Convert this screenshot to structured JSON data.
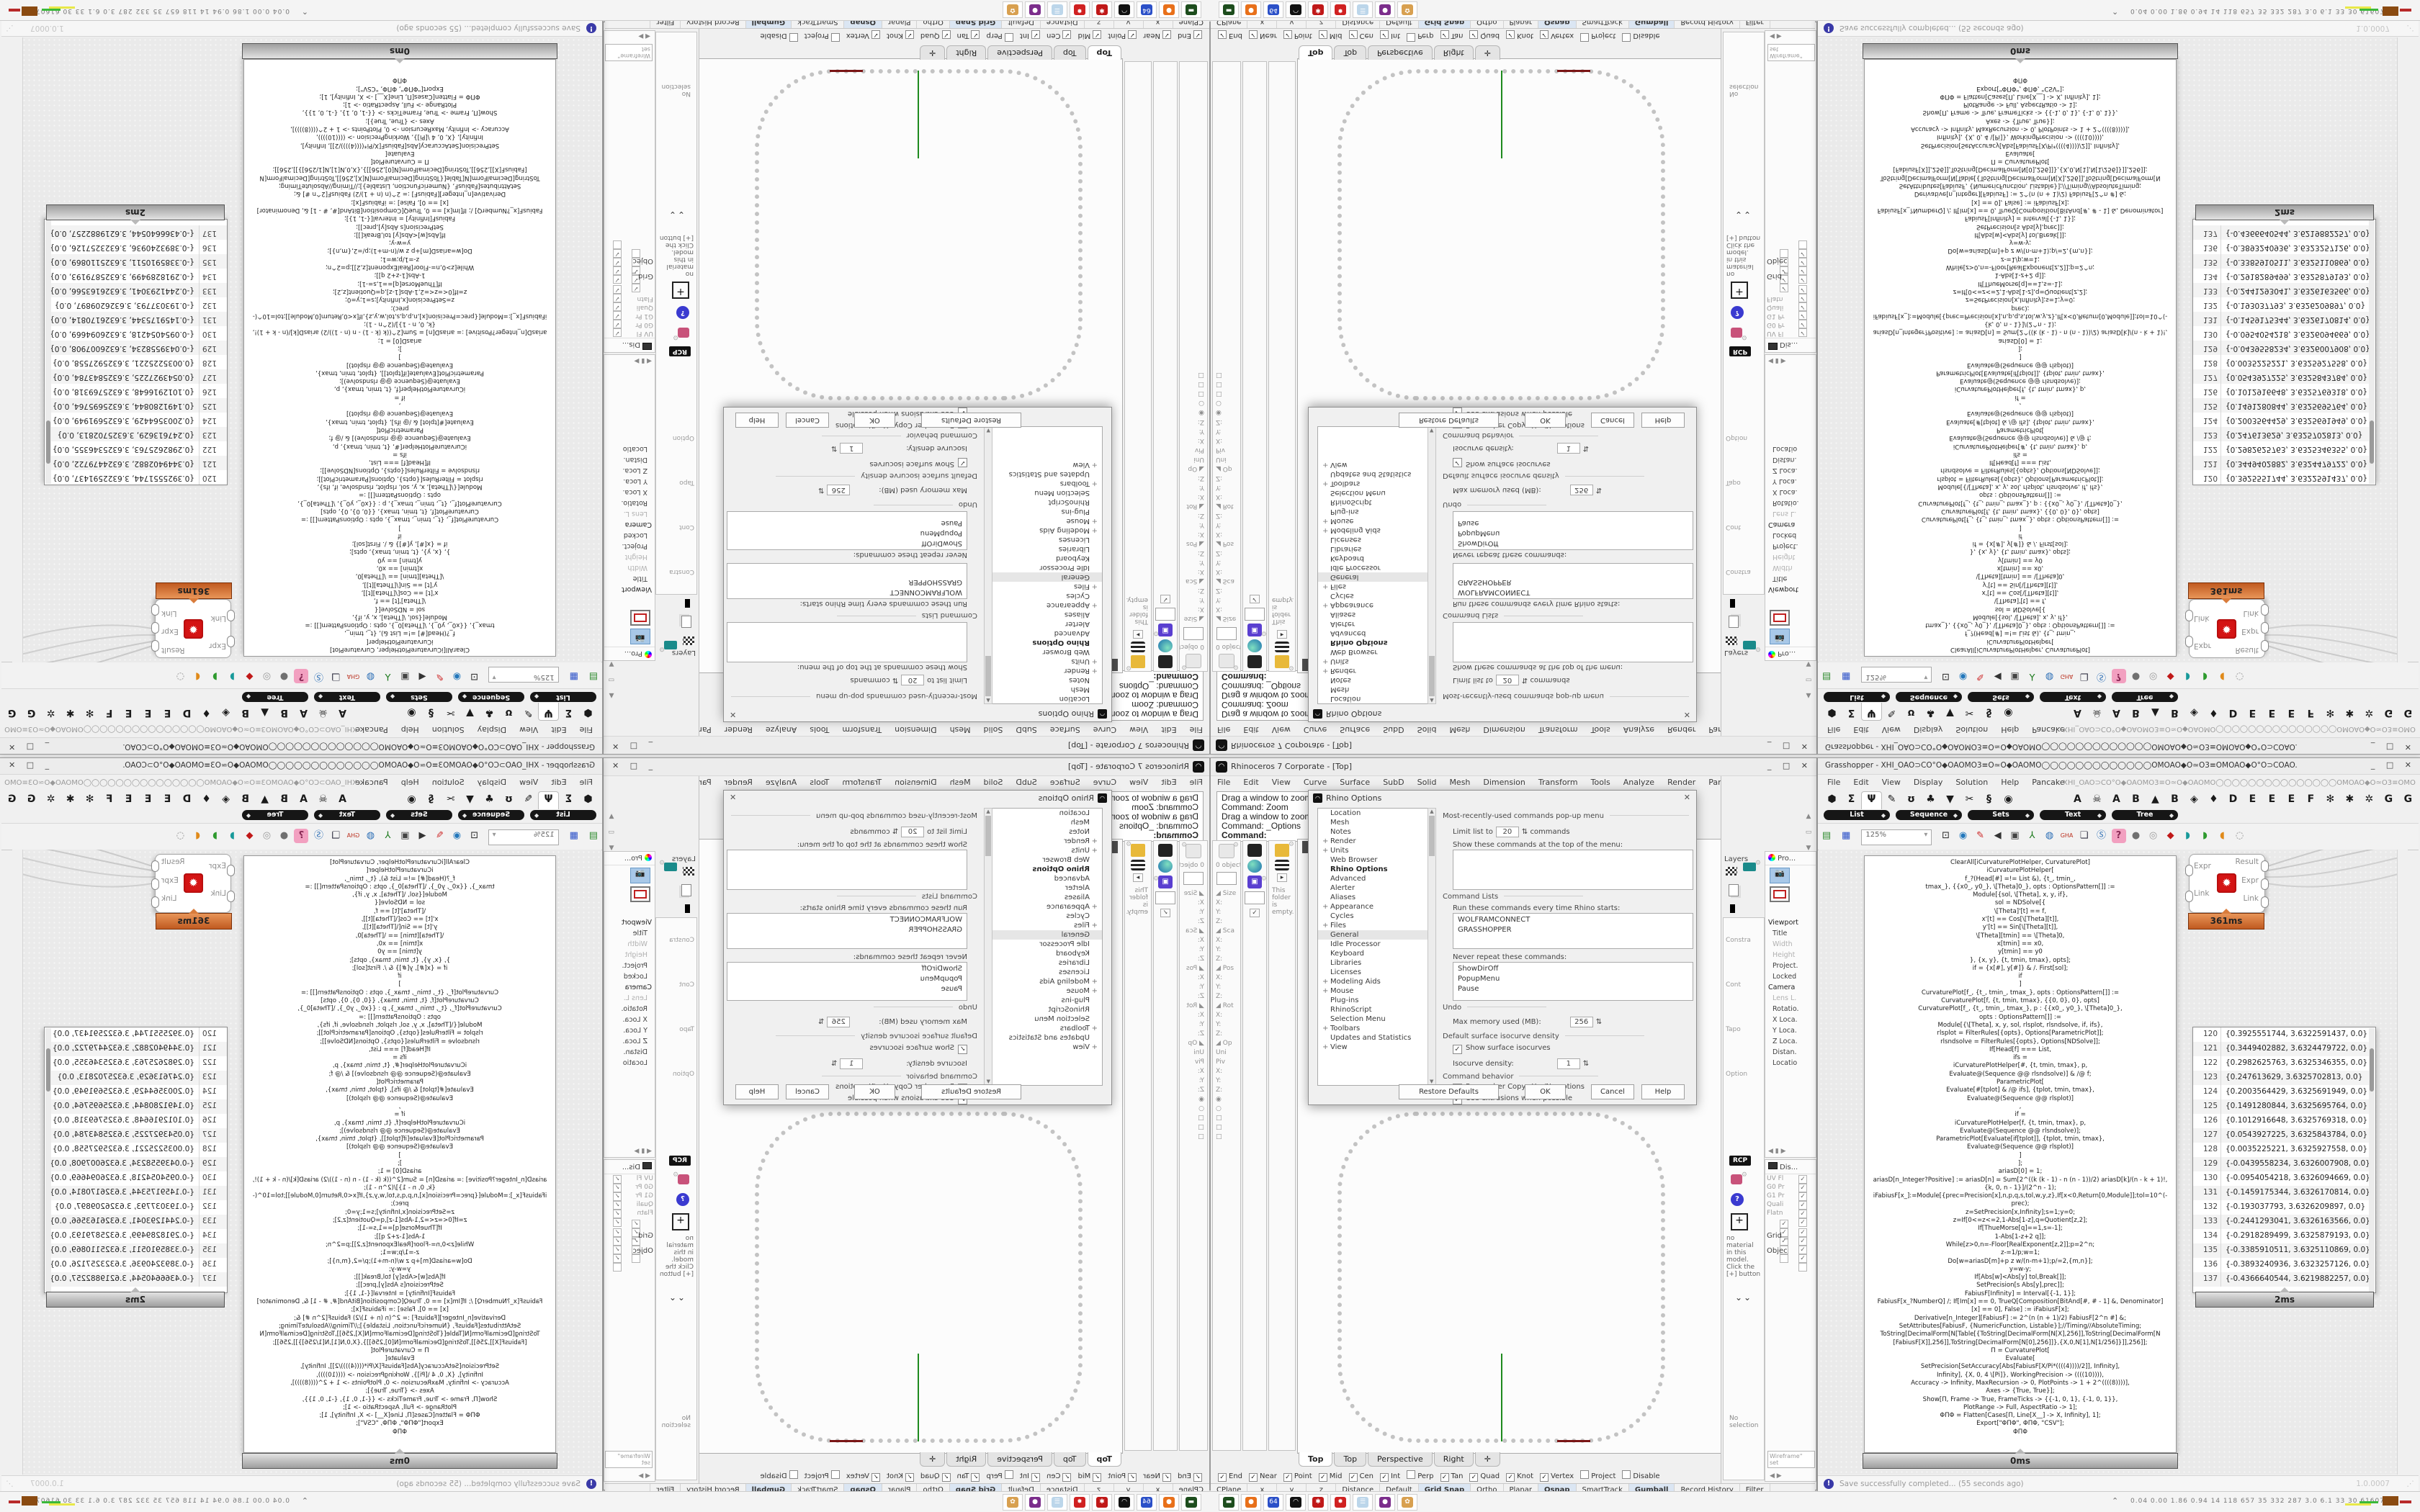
{
  "rhino": {
    "title": "Rhinoceros 7 Corporate - [Top]",
    "window_buttons": "_ □ ✕",
    "menus": [
      "File",
      "Edit",
      "View",
      "Curve",
      "Surface",
      "SubD",
      "Solid",
      "Mesh",
      "Dimension",
      "Transform",
      "Tools",
      "Analyze",
      "Render",
      "Panels",
      "Help"
    ],
    "command_lines": [
      "Drag a window to zoom (",
      "Command: Zoom",
      "Drag a window to zoom (",
      "Command: _Options",
      "Command:"
    ],
    "left_strips": {
      "objects_count": "0 objects",
      "rows": [
        "◢ Size",
        "X:",
        "Y:",
        "Z:",
        "◢ Sca",
        "X:",
        "Y:",
        "Z:",
        "◢ Pos",
        "X:",
        "Y:",
        "Z:",
        "◢ Rot",
        "X:",
        "Y:",
        "Z:",
        "◢ Op",
        "Uni",
        "Piv",
        "X:",
        "Y:",
        "Z:",
        "◉",
        "○",
        "□",
        "□",
        "□"
      ],
      "check": "✓",
      "folder_empty": "This folder is empty.",
      "expand_arrow": "▸"
    },
    "viewport": {
      "label": "Top",
      "tabs": [
        {
          "label": "Top",
          "cls": "active"
        },
        {
          "label": "Top"
        },
        {
          "label": "Perspective"
        },
        {
          "label": "Right"
        },
        {
          "label": "✛"
        }
      ]
    },
    "osnap": [
      {
        "label": "End",
        "chk": "✓"
      },
      {
        "label": "Near",
        "chk": "✓"
      },
      {
        "label": "Point",
        "chk": "✓"
      },
      {
        "label": "Mid",
        "chk": "✓"
      },
      {
        "label": "Cen",
        "chk": "✓"
      },
      {
        "label": "Int",
        "chk": "✓"
      },
      {
        "label": "Perp",
        "chk": ""
      },
      {
        "label": "Tan",
        "chk": "✓"
      },
      {
        "label": "Quad",
        "chk": "✓"
      },
      {
        "label": "Knot",
        "chk": "✓"
      },
      {
        "label": "Vertex",
        "chk": "✓"
      },
      {
        "label": "Project",
        "chk": ""
      },
      {
        "label": "Disable",
        "chk": ""
      }
    ],
    "status_cells": [
      {
        "label": "CPlane",
        "cls": ""
      },
      {
        "label": "x",
        "cls": "wide"
      },
      {
        "label": "y",
        "cls": "wide"
      },
      {
        "label": "z",
        "cls": "wide"
      },
      {
        "label": "Distance",
        "cls": ""
      },
      {
        "label": "Default",
        "cls": "swatch"
      },
      {
        "label": "Grid Snap",
        "cls": "hl"
      },
      {
        "label": "Ortho",
        "cls": ""
      },
      {
        "label": "Planar",
        "cls": ""
      },
      {
        "label": "Osnap",
        "cls": "hl"
      },
      {
        "label": "SmartTrack",
        "cls": ""
      },
      {
        "label": "Gumball",
        "cls": "hl"
      },
      {
        "label": "Record History",
        "cls": ""
      },
      {
        "label": "Filter",
        "cls": ""
      }
    ],
    "options_dialog": {
      "title": "Rhino Options",
      "tree": [
        {
          "label": "Location",
          "plus": ""
        },
        {
          "label": "Mesh",
          "plus": ""
        },
        {
          "label": "Notes",
          "plus": ""
        },
        {
          "label": "Render",
          "plus": "+"
        },
        {
          "label": "Units",
          "plus": "+"
        },
        {
          "label": "Web Browser",
          "plus": ""
        },
        {
          "label": "Rhino Options",
          "plus": "",
          "cls": "hdr"
        },
        {
          "label": "Advanced",
          "plus": ""
        },
        {
          "label": "Alerter",
          "plus": ""
        },
        {
          "label": "Aliases",
          "plus": ""
        },
        {
          "label": "Appearance",
          "plus": "+"
        },
        {
          "label": "Cycles",
          "plus": ""
        },
        {
          "label": "Files",
          "plus": "+"
        },
        {
          "label": "General",
          "plus": "",
          "cls": "sel"
        },
        {
          "label": "Idle Processor",
          "plus": ""
        },
        {
          "label": "Keyboard",
          "plus": ""
        },
        {
          "label": "Libraries",
          "plus": ""
        },
        {
          "label": "Licenses",
          "plus": ""
        },
        {
          "label": "Modeling Aids",
          "plus": "+"
        },
        {
          "label": "Mouse",
          "plus": "+"
        },
        {
          "label": "Plug-ins",
          "plus": ""
        },
        {
          "label": "RhinoScript",
          "plus": ""
        },
        {
          "label": "Selection Menu",
          "plus": ""
        },
        {
          "label": "Toolbars",
          "plus": "+"
        },
        {
          "label": "Updates and Statistics",
          "plus": ""
        },
        {
          "label": "View",
          "plus": "+"
        }
      ],
      "mru_header": "Most-recently-used commands pop-up menu",
      "limit_label": "Limit list to",
      "limit_value": "20",
      "limit_suffix": "commands",
      "show_cmds_label": "Show these commands at the top of the menu:",
      "cmd_lists_header": "Command Lists",
      "run_label": "Run these commands every time Rhino starts:",
      "run_items": [
        "WOLFRAMCONNECT",
        "GRASSHOPPER"
      ],
      "never_label": "Never repeat these commands:",
      "never_items": [
        "ShowDirOff",
        "PopupMenu",
        "Pause"
      ],
      "undo_header": "Undo",
      "max_mem_label": "Max memory used (MB):",
      "max_mem_value": "256",
      "iso_header": "Default surface isocurve density",
      "show_iso_label": "Show surface isocurves",
      "iso_density_label": "Isocurve density:",
      "iso_density_value": "1",
      "behavior_header": "Command behavior",
      "remember_label": "Remember Copy=Yes/No options",
      "extrusions_label": "Use extrusions when possible",
      "buttons": [
        "Restore Defaults",
        "OK",
        "Cancel",
        "Help"
      ]
    },
    "right_dock": {
      "layers_label": "Layers",
      "strip_labels": [
        "Constra",
        "Cont",
        "Tapo",
        "Option"
      ],
      "rcp_label": "RCP",
      "materials_empty": "no material in this model. Click the [+] button",
      "chevrons": "⌄⌄",
      "no_selection": "No selection",
      "properties": {
        "header": "Pro...",
        "rows": [
          {
            "label": "Viewport",
            "cls": "sec"
          },
          {
            "label": "Title",
            "cls": ""
          },
          {
            "label": "Width",
            "cls": "dim"
          },
          {
            "label": "Height",
            "cls": "dim"
          },
          {
            "label": "Project.",
            "cls": ""
          },
          {
            "label": "Locked",
            "cls": ""
          },
          {
            "label": "Camera",
            "cls": "sec"
          },
          {
            "label": "Lens L.",
            "cls": "dim"
          },
          {
            "label": "Rotatio.",
            "cls": ""
          },
          {
            "label": "X Loca.",
            "cls": ""
          },
          {
            "label": "Y Loca.",
            "cls": ""
          },
          {
            "label": "Z Loca.",
            "cls": ""
          },
          {
            "label": "Distan.",
            "cls": ""
          },
          {
            "label": "Locatio",
            "cls": ""
          }
        ]
      },
      "display": {
        "header": "Dis...",
        "rows": [
          {
            "label": "UV Fl",
            "chk": "✓"
          },
          {
            "label": "G0 Pr",
            "chk": "✓"
          },
          {
            "label": "G1 Pr",
            "chk": "✓"
          },
          {
            "label": "Quali",
            "chk": "✓"
          },
          {
            "label": "Flatn",
            "chk": "✓"
          },
          {
            "label": "",
            "chk": "✓"
          },
          {
            "label": "",
            "chk": "✓"
          },
          {
            "label": "",
            "chk": "✓"
          },
          {
            "label": "",
            "chk": "✓"
          },
          {
            "label": "",
            "chk": "✓"
          },
          {
            "label": "",
            "chk": "✓"
          },
          {
            "label": "",
            "chk": "✓"
          }
        ],
        "grid_label": "Grid _",
        "grid_rows": [
          {
            "label": "",
            "chk": ""
          },
          {
            "label": "",
            "chk": "✓"
          },
          {
            "label": "",
            "chk": ""
          },
          {
            "label": "",
            "chk": ""
          }
        ],
        "object_label": "Objec",
        "wireframe_value": "Wireframe\" set"
      }
    }
  },
  "grasshopper": {
    "title": "Grasshopper - XHI_OAO⊃CO°O◆OAOMO3≡O≃O◆OAOMO◯◯◯◯◯◯◯◯◯◯◯◯◯OMOAO◆O≃O3≡OMOAO◆O°O⊃COAO.",
    "window_buttons": "_ □ ✕",
    "menus": [
      "File",
      "Edit",
      "View",
      "Display",
      "Solution",
      "Help",
      "Pancake"
    ],
    "doc_glyphs": "XHI_OAO⊃CO°O◆OAOMO3≡O≃O◆OAOMO◯◯◯◯◯◯◯◯◯◯◯◯◯◯◯OMOAO◆O≃O3≡OMOAO◆O°O⊃COAO.",
    "tab_icons": [
      {
        "g": "⬢",
        "name": "params-tab-icon",
        "cls": ""
      },
      {
        "g": "Σ",
        "name": "maths-tab-icon",
        "cls": ""
      },
      {
        "g": "Ψ",
        "name": "sets-tab-icon",
        "cls": "active"
      },
      {
        "g": "✎",
        "name": "vector-tab-icon",
        "cls": ""
      },
      {
        "g": "ʊ",
        "name": "curve-tab-icon",
        "cls": ""
      },
      {
        "g": "♣",
        "name": "surface-tab-icon",
        "cls": ""
      },
      {
        "g": "▼",
        "name": "mesh-tab-icon",
        "cls": ""
      },
      {
        "g": "✂",
        "name": "intersect-tab-icon",
        "cls": ""
      },
      {
        "g": "§",
        "name": "transform-tab-icon",
        "cls": ""
      },
      {
        "g": "◉",
        "name": "display-tab-icon",
        "cls": ""
      }
    ],
    "plugin_tabs": [
      "A",
      "☠",
      "A",
      "B",
      "▲",
      "B",
      "◈",
      "♦",
      "D",
      "E",
      "E",
      "E",
      "F",
      "✻",
      "✱",
      "✲",
      "G",
      "G"
    ],
    "categories": [
      "List",
      "Sequence",
      "Sets",
      "Text",
      "Tree"
    ],
    "capsule_diamond": "◆",
    "toolbar": {
      "zoom_value": "125%",
      "icons": [
        {
          "g": "▤",
          "name": "open-document-icon",
          "cls": "ic-open"
        },
        {
          "g": "▦",
          "name": "save-document-icon",
          "cls": "ic-save"
        },
        {
          "g": "⊡",
          "name": "zoom-extents-icon",
          "cls": "ic-fit"
        },
        {
          "g": "◉",
          "name": "preview-eye-icon",
          "cls": "ic-eye"
        },
        {
          "g": "✎",
          "name": "redraw-pen-icon",
          "cls": "ic-pen"
        },
        {
          "g": "◀",
          "name": "megaphone-icon",
          "cls": "ic-horn"
        },
        {
          "g": "▣",
          "name": "cassette-icon",
          "cls": "ic-cass"
        },
        {
          "g": "⅄",
          "name": "axes-widget-icon",
          "cls": "ic-axes"
        },
        {
          "g": "◍",
          "name": "remote-control-icon",
          "cls": "ic-rem"
        },
        {
          "g": "GHA",
          "name": "gha-installer-icon",
          "cls": "ic-gha"
        },
        {
          "g": "❏",
          "name": "window-flag-icon",
          "cls": "ic-flag"
        },
        {
          "g": "Ⓢ",
          "name": "finder-icon",
          "cls": "ic-sfind"
        },
        {
          "g": "?",
          "name": "surprise-box-icon",
          "cls": "ic-gift"
        },
        {
          "g": "●",
          "name": "sphere-display-icon",
          "cls": "ic-sph"
        },
        {
          "g": "◎",
          "name": "torus-display-icon",
          "cls": "ic-tor"
        },
        {
          "g": "◆",
          "name": "gem-display-icon",
          "cls": "ic-gem"
        },
        {
          "g": "◗",
          "name": "bucket-teal-icon",
          "cls": "ic-bt"
        },
        {
          "g": "◗",
          "name": "bucket-green-icon",
          "cls": "ic-bg"
        },
        {
          "g": "◖",
          "name": "bucket-orange-icon",
          "cls": "ic-bo"
        },
        {
          "g": "◌",
          "name": "lasso-select-icon",
          "cls": "ic-lasso"
        }
      ]
    },
    "code_panel": {
      "badge": "0ms",
      "lines": [
        "ClearAll[iCurvaturePlotHelper, CurvaturePlot]",
        "iCurvaturePlotHelper[",
        "f_?(Head[#] =!= List &), {t_, tmin_,",
        "tmax_}, {{x0_, y0_}, \\[Theta]0_}, opts : OptionsPattern[]] :=",
        "Module[{sol, \\[Theta], x, y, if},",
        "sol = NDSolve[{",
        "\\[Theta]'[t] == f,",
        "x'[t] == Cos[\\[Theta][t]],",
        "y'[t] == Sin[\\[Theta][t]],",
        "\\[Theta][tmin] == \\[Theta]0,",
        "x[tmin] == x0,",
        "y[tmin] == y0",
        "}, {x, y}, {t, tmin, tmax}, opts];",
        "if = {x[#], y[#]} & /. First[sol];",
        "if",
        "]",
        "CurvaturePlot[f_, {t_, tmin_, tmax_}, opts : OptionsPattern[]] :=",
        "CurvaturePlot[f, {t, tmin, tmax}, {{0, 0}, 0}, opts]",
        "CurvaturePlot[f_, {t_, tmin_, tmax_}, p : {{x0_, y0_}, \\[Theta]0_},",
        "opts : OptionsPattern[]] :=",
        "Module[{\\[Theta], x, y, sol, rlsplot, rlsndsolve, if, ifs},",
        "rlsplot = FilterRules[{opts}, Options[ParametricPlot]];",
        "rlsndsolve = FilterRules[{opts}, Options[NDSolve]];",
        "If[Head[f] === List,",
        "ifs =",
        "iCurvaturePlotHelper[#, {t, tmin, tmax}, p,",
        "Evaluate@(Sequence @@ rlsndsolve)] & /@ f;",
        "ParametricPlot[",
        "Evaluate[#[tplot] & /@ ifs], {tplot, tmin, tmax},",
        "Evaluate@(Sequence @@ rlsplot)]",
        ",",
        "if =",
        "iCurvaturePlotHelper[f, {t, tmin, tmax}, p,",
        "Evaluate@(Sequence @@ rlsndsolve)];",
        "ParametricPlot[Evaluate[if[tplot]], {tplot, tmin, tmax},",
        "Evaluate@(Sequence @@ rlsplot)]",
        "]",
        "];",
        "",
        "ariasD[0] = 1;",
        "ariasD[n_Integer?Positive] := ariasD[n] = Sum[2^((k (k - 1) - n (n - 1))/2) ariasD[k]/(n - k + 1)!,",
        "{k, 0, n - 1}]/(2^n - 1);",
        "iFabiusF[x_]:=Module[{prec=Precision[x],n,p,q,s,tol,w,y,z},If[x<0,Return[0,Module]];tol=10^(-",
        "prec);",
        "z=SetPrecision[x,Infinity];s=1;y=0;",
        "z=If[0<=z<=2,1-Abs[1-z],q=Quotient[z,2];",
        "If[ThueMorse[q]==1,s=-1];",
        "1-Abs[1-z+2 q]];",
        "While[z>0,n=-Floor[RealExponent[z,2]];p=2^n;",
        "z-=1/p;w=1;",
        "Do[w=ariasD[m]+p z w/(n-m+1);p/=2,{m,n}];",
        "y=w-y;",
        "If[Abs[w]<Abs[y] tol,Break[]];",
        "SetPrecision[s Abs[y],prec]];",
        "FabiusF[Infinity] = Interval[{-1, 1}];",
        "FabiusF[x_?NumberQ] /; If[Im[x] == 0, TrueQ[Composition[BitAnd[#, # - 1] &, Denominator]",
        "[x] == 0], False] := iFabiusF[x];",
        "Derivative[n_Integer][FabiusF] := 2^(n (n + 1)/2) FabiusF[2^n #] &;",
        "SetAttributes[FabiusF, {NumericFunction, Listable}];//Timing//AbsoluteTiming;",
        "",
        "ToString[DecimalForm[N[Table[{ToString[DecimalForm[N[X],256]],ToString[DecimalForm[N",
        "[FabiusF[X]],256]],ToString[DecimalForm[N[0],256]]},{X,0,N[1],N[1/256]}]],256]];",
        "",
        "Π = CurvaturePlot[",
        "Evaluate[",
        "SetPrecision[SetAccuracy[Abs[FabiusF[X/Pi*((((4))))/2]], Infinity],",
        "Infinity], {X, 0, 4 \\[Pi]}, WorkingPrecision -> ((((10)))),",
        "Accuracy -> Infinity, MaxRecursion -> 0, PlotPoints -> 1 + 2^((((8))))],",
        "Axes -> {True, True}];",
        "Show[Π, Frame -> True, FrameTicks -> {{-1, 0, 1}, {-1, 0, 1}},",
        "PlotRange -> Full, AspectRatio -> 1];",
        "ΦΠΦ = Flatten[Cases[Π, Line[X__] -> X, Infinity], 1];",
        "Export[\"ΦΠΦ\", ΦΠΦ, \"CSV\"];",
        "ΦΠΦ"
      ]
    },
    "component": {
      "inputs": [
        "Expr",
        "Link"
      ],
      "outputs": [
        "Result",
        "Expr",
        "Link"
      ],
      "logo_glyph": "✹",
      "badge": "361ms"
    },
    "points_panel": {
      "badge": "2ms",
      "rows": [
        {
          "n": "120",
          "v": "{0.3925551744, 3.6322591437, 0.0}"
        },
        {
          "n": "121",
          "v": "{0.3449402882, 3.6324479722, 0.0}"
        },
        {
          "n": "122",
          "v": "{0.2982625763, 3.6325346355, 0.0}"
        },
        {
          "n": "123",
          "v": "{0.247613629, 3.6325702813, 0.0}"
        },
        {
          "n": "124",
          "v": "{0.2003564429, 3.6325691949, 0.0}"
        },
        {
          "n": "125",
          "v": "{0.1491280844, 3.6325695764, 0.0}"
        },
        {
          "n": "126",
          "v": "{0.1012916648, 3.6325769318, 0.0}"
        },
        {
          "n": "127",
          "v": "{0.0543927225, 3.6325843784, 0.0}"
        },
        {
          "n": "128",
          "v": "{0.0035225221, 3.6325927558, 0.0}"
        },
        {
          "n": "129",
          "v": "{-0.0439558234, 3.6326007908, 0.0}"
        },
        {
          "n": "130",
          "v": "{-0.0954054218, 3.6326094669, 0.0}"
        },
        {
          "n": "131",
          "v": "{-0.1459175344, 3.6326170814, 0.0}"
        },
        {
          "n": "132",
          "v": "{-0.193037793, 3.6326209897, 0.0}"
        },
        {
          "n": "133",
          "v": "{-0.2441293041, 3.6326163566, 0.0}"
        },
        {
          "n": "134",
          "v": "{-0.2918289499, 3.6325879193, 0.0}"
        },
        {
          "n": "135",
          "v": "{-0.3385910511, 3.6325110869, 0.0}"
        },
        {
          "n": "136",
          "v": "{-0.3893240936, 3.6323257126, 0.0}"
        },
        {
          "n": "137",
          "v": "{-0.4366640544, 3.6219882257, 0.0}"
        }
      ]
    },
    "status": {
      "message": "Save successfully completed... (55 seconds ago)",
      "version": "1.0.0007"
    }
  },
  "taskbar": {
    "icons": [
      {
        "name": "recorder-app-icon",
        "bg": "#1d4d1d",
        "g": "▬"
      },
      {
        "name": "firefox-icon",
        "bg": "#e8701a",
        "g": "●"
      },
      {
        "name": "floppy-64-icon",
        "bg": "#2b50c8",
        "g": "64"
      },
      {
        "name": "rhinoceros-icon",
        "bg": "#111111",
        "g": "◠"
      },
      {
        "name": "red-gear-circle-icon",
        "bg": "#c01818",
        "g": "✱"
      },
      {
        "name": "red-gear-square-icon",
        "bg": "#d02020",
        "g": "✸"
      },
      {
        "name": "notepad-icon",
        "bg": "#bcd6ea",
        "g": "☰"
      },
      {
        "name": "gitkraken-icon",
        "bg": "#7b2d8b",
        "g": "●"
      },
      {
        "name": "palette-icon",
        "bg": "#d8a050",
        "g": "✿"
      }
    ],
    "tray_chevron": "⌃",
    "stats": "0.04 0.00 1.86 0.94   14   118   657   35   332   287   3.0   6.1   33   30  61607592"
  }
}
